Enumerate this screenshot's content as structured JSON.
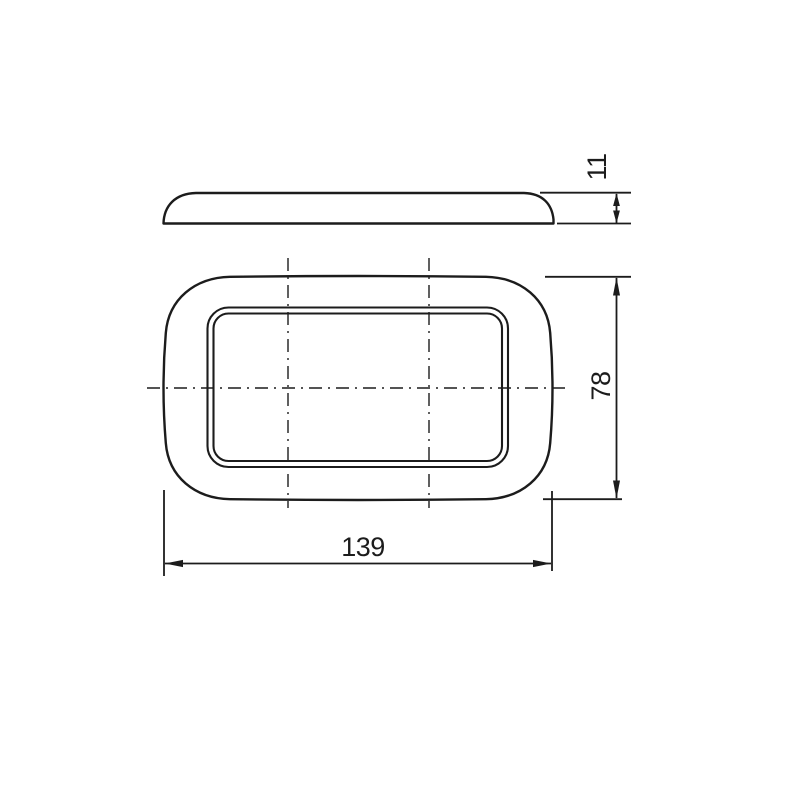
{
  "page": {
    "background_color": "#ffffff"
  },
  "drawing": {
    "line_color": "#1c1c1c",
    "views": {
      "side_profile": {
        "description": "plate side profile view"
      },
      "front": {
        "description": "plate front view with inner opening and centerlines"
      }
    },
    "dimensions": {
      "thickness": {
        "label": "11"
      },
      "height": {
        "label": "78"
      },
      "width": {
        "label": "139"
      }
    }
  }
}
